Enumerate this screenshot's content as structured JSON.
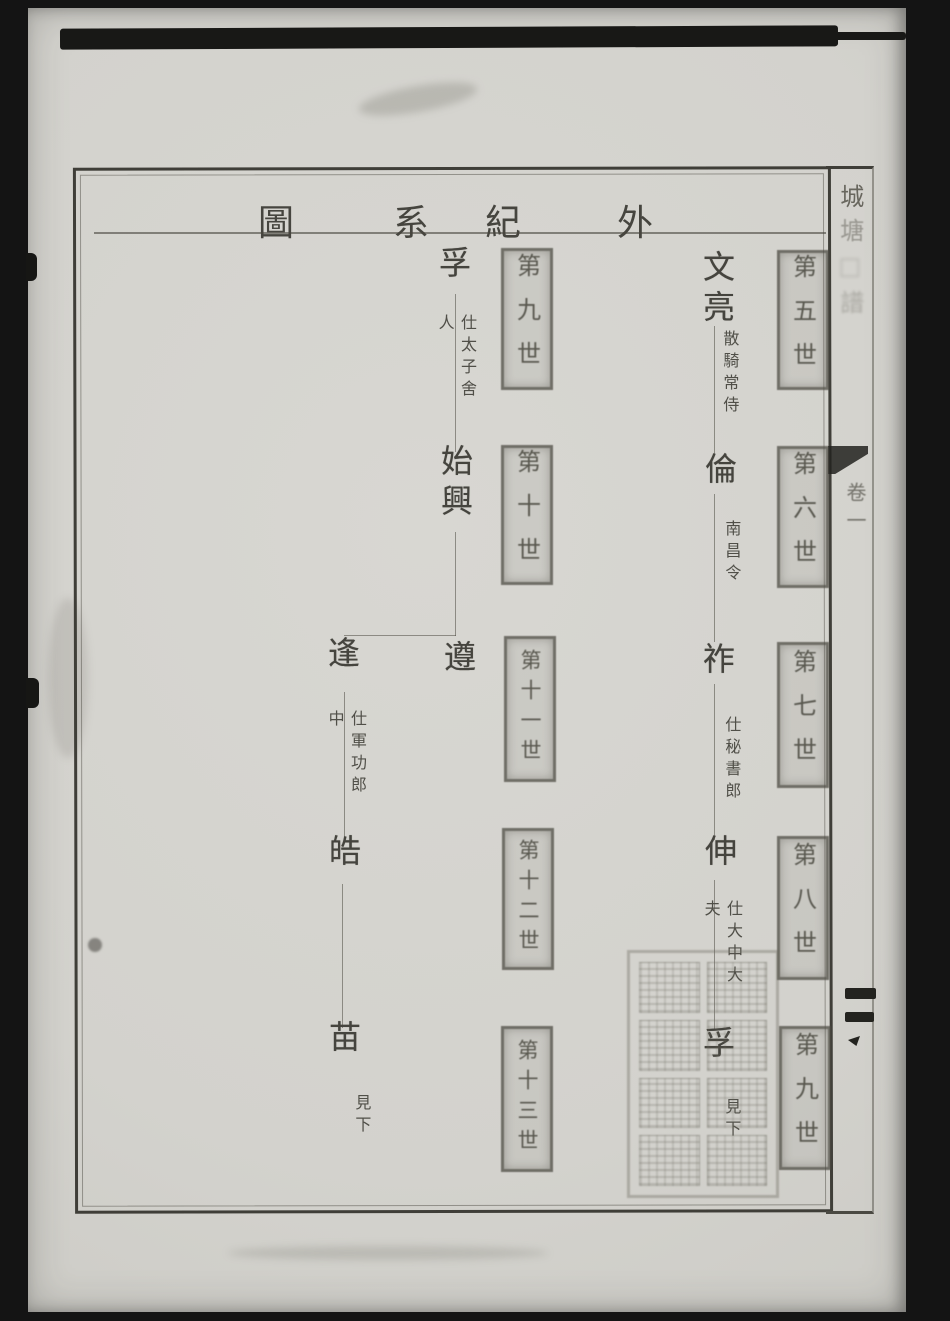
{
  "header": {
    "title": "外紀系圖",
    "title_chars": [
      "圖",
      "系",
      "紀",
      "外"
    ]
  },
  "margin": {
    "book_title": "城塘□譜",
    "book_title_chars": [
      "城",
      "塘",
      "□",
      "譜"
    ],
    "volume_label": "卷一"
  },
  "tree": {
    "right_column": {
      "nodes": [
        {
          "name": "文亮",
          "annotation": "散騎常侍",
          "generation": "第五世"
        },
        {
          "name": "倫",
          "annotation": "南昌令",
          "generation": "第六世"
        },
        {
          "name": "祚",
          "annotation": "仕秘書郎",
          "generation": "第七世"
        },
        {
          "name": "伸",
          "annotation": "仕大中大夫",
          "generation": "第八世"
        },
        {
          "name": "孚",
          "annotation": "見下",
          "generation": "第九世"
        }
      ]
    },
    "middle_column": {
      "nodes": [
        {
          "name": "孚",
          "annotation": "仕太子舍人",
          "generation": "第九世"
        },
        {
          "name": "始興",
          "annotation": "",
          "generation": "第十世"
        },
        {
          "name": "遵",
          "annotation": "",
          "generation": "第十一世"
        },
        {
          "name": "逢",
          "annotation": "仕軍功郎中",
          "generation": "第十一世"
        },
        {
          "name": "皓",
          "annotation": "",
          "generation": "第十二世"
        },
        {
          "name": "苗",
          "annotation": "見下",
          "generation": "第十三世"
        }
      ]
    }
  },
  "seal": {
    "legible": false
  },
  "colors": {
    "paper": "#d6d5d0",
    "ink": "#43423c",
    "background": "#141414"
  }
}
